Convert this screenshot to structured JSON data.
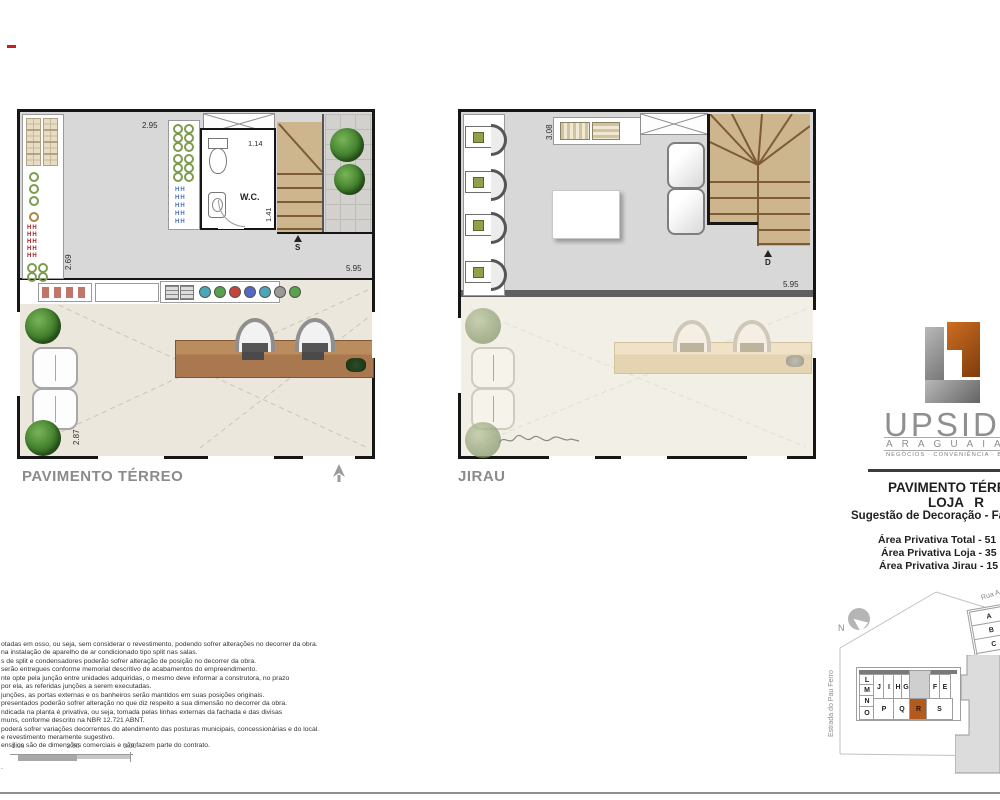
{
  "plans": {
    "terreo": {
      "label": "PAVIMENTO TÉRREO",
      "dim_top": "2.95",
      "dim_wc_width": "1.14",
      "dim_wc_depth": "1.41",
      "dim_left": "2.69",
      "dim_right": "5.95",
      "dim_bottom": "2.87",
      "wc_label": "W.C.",
      "stair_direction": "S"
    },
    "jirau": {
      "label": "JIRAU",
      "dim_top": "3.08",
      "dim_right": "5.95",
      "stair_direction": "D"
    }
  },
  "logo": {
    "name": "UPSIDE",
    "brand": "ARAGUAIA",
    "tagline": "NEGÓCIOS · CONVENIÊNCIA · BEM",
    "accent_orange": "#b5591c",
    "accent_gray": "#8c8c8c"
  },
  "info": {
    "title": "PAVIMENTO TÉRREO",
    "unit": "LOJA R",
    "subtitle": "Sugestão de Decoração - Fa",
    "area_total": "Área Privativa Total - 51",
    "area_loja": "Área Privativa Loja - 35",
    "area_jirau": "Área Privativa Jirau - 15"
  },
  "site_map": {
    "north_label": "N",
    "street_left": "Estrada do Pau Ferro",
    "street_top": "Rua A",
    "left_column": [
      "L",
      "M",
      "N",
      "O"
    ],
    "row_top": [
      "J",
      "I",
      "H",
      "G"
    ],
    "row_top_right": [
      "F",
      "E"
    ],
    "row_bottom": [
      "P",
      "Q",
      "R",
      "S"
    ],
    "side_building": [
      "A",
      "B",
      "C",
      "D"
    ],
    "highlighted_unit": "R",
    "highlight_color": "#b35a1f"
  },
  "scale_bar": {
    "labels": [
      "1.00",
      "2.00",
      "3.00"
    ]
  },
  "disclaimer": {
    "lines": [
      "otadas em osso, ou seja, sem considerar o revestimento, podendo sofrer alterações no decorrer da obra.",
      "na instalação de aparelho de ar condicionado tipo split nas salas.",
      "s de split e condensadores poderão sofrer alteração de posição no decorrer da obra.",
      "serão entregues conforme memorial descritivo de acabamentos do empreendimento.",
      "nte opte pela junção entre unidades adquiridas, o mesmo deve informar a construtora, no prazo",
      "por ela, as referidas junções a serem executadas.",
      "junções, as portas externas e os banheiros serão mantidos em suas posições originais.",
      "presentados poderão sofrer alteração no que diz respeito a sua dimensão no decorrer da obra.",
      "ndicada na planta é privativa, ou seja, tomada pelas linhas externas da fachada e das divisas",
      "muns, conforme descrito na NBR 12.721 ABNT.",
      "poderá sofrer variações decorrentes do atendimento das posturas municipais, concessionárias e do local.",
      "e revestimento meramente sugestivo.",
      "ensílios são de dimensões comerciais e não fazem parte do contrato."
    ],
    "footnote": "."
  },
  "icons": {
    "shelf_mark": "HH"
  }
}
